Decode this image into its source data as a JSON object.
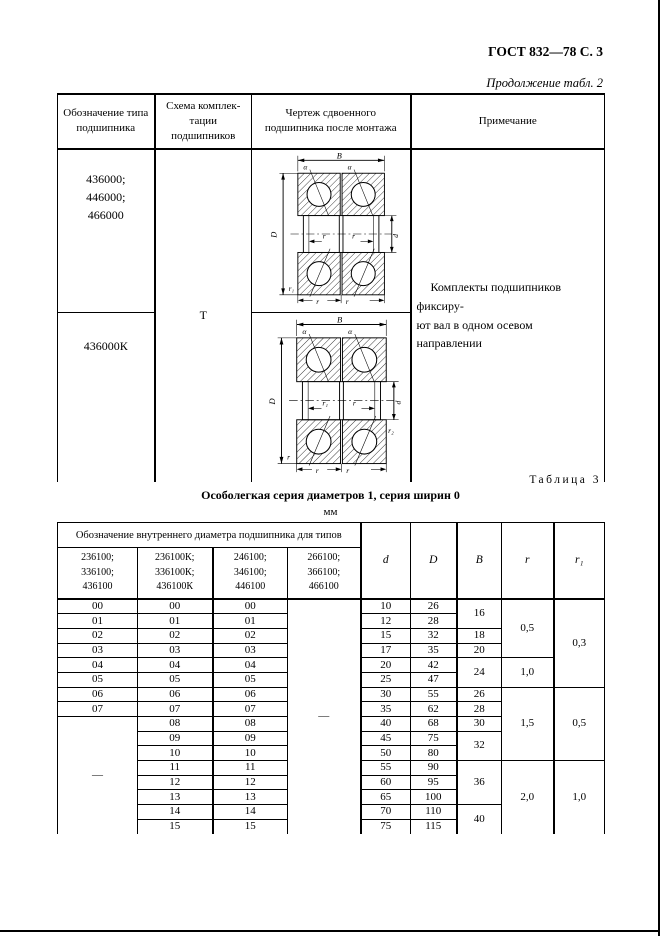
{
  "page": {
    "gost_header": "ГОСТ 832—78 С. 3",
    "continuation": "Продолжение табл. 2",
    "table3_caption": "Таблица 3",
    "table3_title": "Особолегкая серия диаметров 1, серия ширин 0",
    "table3_units": "мм"
  },
  "table2": {
    "headers": [
      "Обозначение типа подшипника",
      "Схема комплек-тации подшипников",
      "Чертеж сдвоенного подшипника после монтажа",
      "Примечание"
    ],
    "row1_designation": "436000;\n446000;\n466000",
    "row2_designation": "436000К",
    "scheme": "Т",
    "note": "Комплекты подшипников фиксиру-\nют вал в одном осевом направлении"
  },
  "drawing_labels": {
    "B": "B",
    "alpha": "α",
    "D": "D",
    "d": "d",
    "r": "r",
    "r1": "r₁",
    "r2": "r₂"
  },
  "table3": {
    "group_header": "Обозначение внутреннего диаметра подшипника для типов",
    "types": [
      "236100;\n336100;\n436100",
      "236100К;\n336100К;\n436100К",
      "246100;\n346100;\n446100",
      "266100;\n366100;\n466100"
    ],
    "col_headers": [
      "d",
      "D",
      "B",
      "r",
      "r₁"
    ],
    "dash": "—",
    "rows": [
      {
        "c1": "00",
        "c2": "00",
        "c3": "00",
        "d": "10",
        "D": "26",
        "B": "16",
        "r": "0,5",
        "r1": "0,3"
      },
      {
        "c1": "01",
        "c2": "01",
        "c3": "01",
        "d": "12",
        "D": "28"
      },
      {
        "c1": "02",
        "c2": "02",
        "c3": "02",
        "d": "15",
        "D": "32",
        "B": "18"
      },
      {
        "c1": "03",
        "c2": "03",
        "c3": "03",
        "d": "17",
        "D": "35",
        "B": "20"
      },
      {
        "c1": "04",
        "c2": "04",
        "c3": "04",
        "d": "20",
        "D": "42",
        "B": "24",
        "r": "1,0"
      },
      {
        "c1": "05",
        "c2": "05",
        "c3": "05",
        "d": "25",
        "D": "47"
      },
      {
        "c1": "06",
        "c2": "06",
        "c3": "06",
        "d": "30",
        "D": "55",
        "B": "26",
        "r": "1,5",
        "r1": "0,5"
      },
      {
        "c1": "07",
        "c2": "07",
        "c3": "07",
        "d": "35",
        "D": "62",
        "B": "28"
      },
      {
        "c2": "08",
        "c3": "08",
        "d": "40",
        "D": "68",
        "B": "30"
      },
      {
        "c2": "09",
        "c3": "09",
        "d": "45",
        "D": "75",
        "B": "32"
      },
      {
        "c2": "10",
        "c3": "10",
        "d": "50",
        "D": "80"
      },
      {
        "c2": "11",
        "c3": "11",
        "d": "55",
        "D": "90",
        "B": "36",
        "r": "2,0",
        "r1": "1,0"
      },
      {
        "c2": "12",
        "c3": "12",
        "d": "60",
        "D": "95"
      },
      {
        "c2": "13",
        "c3": "13",
        "d": "65",
        "D": "100"
      },
      {
        "c2": "14",
        "c3": "14",
        "d": "70",
        "D": "110",
        "B": "40"
      },
      {
        "c2": "15",
        "c3": "15",
        "d": "75",
        "D": "115"
      }
    ]
  }
}
